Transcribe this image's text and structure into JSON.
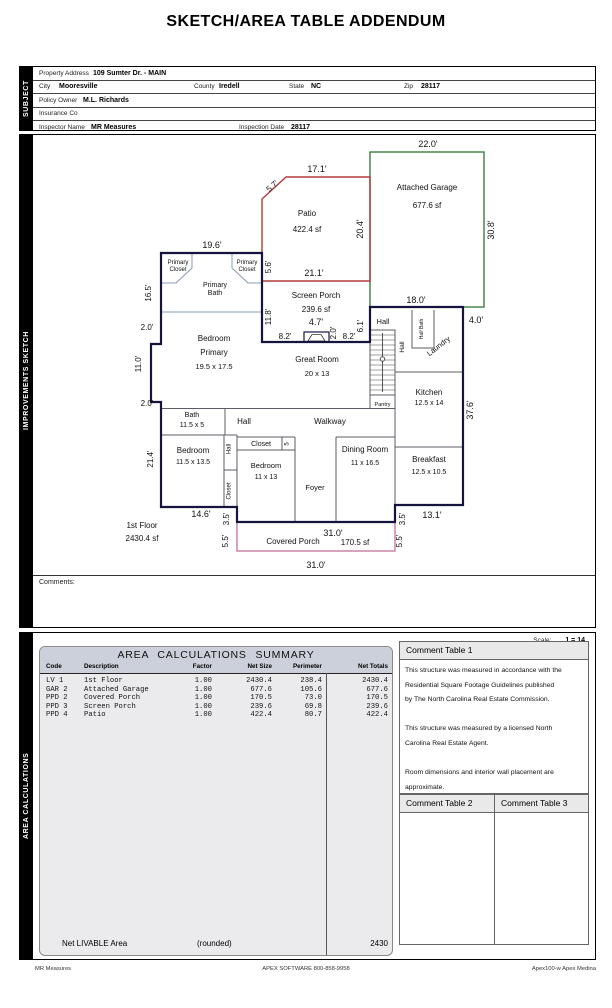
{
  "title": "SKETCH/AREA TABLE ADDENDUM",
  "sidebar": {
    "subject": "SUBJECT",
    "improvements": "IMPROVEMENTS SKETCH",
    "area_calc": "AREA CALCULATIONS"
  },
  "subject": {
    "rows": [
      [
        {
          "x": 6,
          "t": "Property Address"
        },
        {
          "x": 60,
          "t": "109 Sumter Dr. - MAIN",
          "b": 1
        }
      ],
      [
        {
          "x": 6,
          "t": "City"
        },
        {
          "x": 26,
          "t": "Mooresville",
          "b": 1
        },
        {
          "x": 161,
          "t": "County"
        },
        {
          "x": 186,
          "t": "Iredell",
          "b": 1
        },
        {
          "x": 256,
          "t": "State"
        },
        {
          "x": 278,
          "t": "NC",
          "b": 1
        },
        {
          "x": 371,
          "t": "Zip"
        },
        {
          "x": 388,
          "t": "28117",
          "b": 1
        }
      ],
      [
        {
          "x": 6,
          "t": "Policy Owner"
        },
        {
          "x": 50,
          "t": "M.L. Richards",
          "b": 1
        }
      ],
      [
        {
          "x": 6,
          "t": "Insurance Co"
        }
      ],
      [
        {
          "x": 6,
          "t": "Inspector Name"
        },
        {
          "x": 58,
          "t": "MR Measures",
          "b": 1
        },
        {
          "x": 206,
          "t": "Inspection Date"
        },
        {
          "x": 258,
          "t": "28117",
          "b": 1
        }
      ]
    ]
  },
  "sketch": {
    "comments_label": "Comments:",
    "labels": [
      {
        "t": "22.0'",
        "x": 395,
        "y": 12,
        "s": 9
      },
      {
        "t": "Attached Garage",
        "x": 394,
        "y": 55,
        "s": 8
      },
      {
        "t": "677.6 sf",
        "x": 394,
        "y": 73,
        "s": 8
      },
      {
        "t": "30.8'",
        "x": 461,
        "y": 95,
        "s": 9,
        "r": -90
      },
      {
        "t": "18.0'",
        "x": 383,
        "y": 168,
        "s": 9
      },
      {
        "t": "4.0'",
        "x": 443,
        "y": 188,
        "s": 9
      },
      {
        "t": "5.7'",
        "x": 241,
        "y": 53,
        "s": 8,
        "r": -42
      },
      {
        "t": "17.1'",
        "x": 284,
        "y": 37,
        "s": 9
      },
      {
        "t": "Patio",
        "x": 274,
        "y": 81,
        "s": 8
      },
      {
        "t": "422.4 sf",
        "x": 274,
        "y": 97,
        "s": 8
      },
      {
        "t": "20.4'",
        "x": 330,
        "y": 94,
        "s": 9,
        "r": -90
      },
      {
        "t": "5.6'",
        "x": 238,
        "y": 132,
        "s": 8,
        "r": -90
      },
      {
        "t": "21.1'",
        "x": 281,
        "y": 141,
        "s": 9
      },
      {
        "t": "19.6'",
        "x": 179,
        "y": 113,
        "s": 9
      },
      {
        "t": "Primary",
        "x": 145,
        "y": 129,
        "s": 6
      },
      {
        "t": "Closet",
        "x": 145,
        "y": 136,
        "s": 6
      },
      {
        "t": "Primary",
        "x": 214,
        "y": 129,
        "s": 6
      },
      {
        "t": "Closet",
        "x": 214,
        "y": 136,
        "s": 6
      },
      {
        "t": "Primary",
        "x": 182,
        "y": 152,
        "s": 7
      },
      {
        "t": "Bath",
        "x": 182,
        "y": 160,
        "s": 7
      },
      {
        "t": "16.5'",
        "x": 118,
        "y": 158,
        "s": 8,
        "r": -90
      },
      {
        "t": "Screen Porch",
        "x": 283,
        "y": 163,
        "s": 8
      },
      {
        "t": "239.6 sf",
        "x": 283,
        "y": 177,
        "s": 8
      },
      {
        "t": "11.8'",
        "x": 238,
        "y": 182,
        "s": 8,
        "r": -90
      },
      {
        "t": "4.7'",
        "x": 283,
        "y": 190,
        "s": 9
      },
      {
        "t": "8.2'",
        "x": 252,
        "y": 204,
        "s": 8
      },
      {
        "t": "2.0'",
        "x": 303,
        "y": 198,
        "s": 8,
        "r": -90
      },
      {
        "t": "8.2'",
        "x": 316,
        "y": 204,
        "s": 8
      },
      {
        "t": "6.1'",
        "x": 330,
        "y": 191,
        "s": 8,
        "r": -90
      },
      {
        "t": "2.0'",
        "x": 114,
        "y": 195,
        "s": 8
      },
      {
        "t": "Bedroom",
        "x": 181,
        "y": 206,
        "s": 8
      },
      {
        "t": "Primary",
        "x": 181,
        "y": 220,
        "s": 8
      },
      {
        "t": "19.5 x 17.5",
        "x": 181,
        "y": 234,
        "s": 7.5
      },
      {
        "t": "11.0'",
        "x": 108,
        "y": 229,
        "s": 8,
        "r": -90
      },
      {
        "t": "2.0'",
        "x": 114,
        "y": 271,
        "s": 8
      },
      {
        "t": "Great Room",
        "x": 284,
        "y": 227,
        "s": 8
      },
      {
        "t": "20 x 13",
        "x": 284,
        "y": 241,
        "s": 7.5
      },
      {
        "t": "Hall",
        "x": 350,
        "y": 189,
        "s": 7.5
      },
      {
        "t": "Half Bath",
        "x": 390,
        "y": 194,
        "s": 5,
        "r": -90
      },
      {
        "t": "Hall",
        "x": 371,
        "y": 212,
        "s": 6.5,
        "r": -90
      },
      {
        "t": "Laundry",
        "x": 407,
        "y": 213,
        "s": 7.5,
        "r": -38
      },
      {
        "t": "Kitchen",
        "x": 396,
        "y": 260,
        "s": 8
      },
      {
        "t": "12.5 x 14",
        "x": 396,
        "y": 270,
        "s": 7
      },
      {
        "t": "37.6'",
        "x": 440,
        "y": 275,
        "s": 9,
        "r": -90
      },
      {
        "t": "Pantry",
        "x": 349.5,
        "y": 271,
        "s": 5.5
      },
      {
        "t": "Bath",
        "x": 159,
        "y": 282,
        "s": 7
      },
      {
        "t": "11.5 x 5",
        "x": 159,
        "y": 292,
        "s": 7
      },
      {
        "t": "Hall",
        "x": 211,
        "y": 289,
        "s": 8
      },
      {
        "t": "Walkway",
        "x": 297,
        "y": 289,
        "s": 8
      },
      {
        "t": "21.4'",
        "x": 120,
        "y": 324,
        "s": 8,
        "r": -90
      },
      {
        "t": "Bedroom",
        "x": 160,
        "y": 318,
        "s": 8
      },
      {
        "t": "11.5 x 13.5",
        "x": 160,
        "y": 329,
        "s": 7
      },
      {
        "t": "Hall",
        "x": 197.5,
        "y": 314,
        "s": 6,
        "r": -90
      },
      {
        "t": "Closet",
        "x": 228,
        "y": 311,
        "s": 7
      },
      {
        "t": "5",
        "x": 255.5,
        "y": 309,
        "s": 6,
        "r": -90
      },
      {
        "t": "Bedroom",
        "x": 233,
        "y": 333,
        "s": 7.5
      },
      {
        "t": "11 x 13",
        "x": 233,
        "y": 344,
        "s": 7
      },
      {
        "t": "Closet",
        "x": 197.5,
        "y": 356,
        "s": 6,
        "r": -90
      },
      {
        "t": "Foyer",
        "x": 282,
        "y": 355,
        "s": 7.5
      },
      {
        "t": "Dining Room",
        "x": 332,
        "y": 317,
        "s": 8
      },
      {
        "t": "11 x 16.5",
        "x": 332,
        "y": 330,
        "s": 7
      },
      {
        "t": "Breakfast",
        "x": 396,
        "y": 327,
        "s": 8
      },
      {
        "t": "12.5 x 10.5",
        "x": 396,
        "y": 339,
        "s": 7
      },
      {
        "t": "14.6'",
        "x": 168,
        "y": 382,
        "s": 9
      },
      {
        "t": "3.5'",
        "x": 196,
        "y": 384,
        "s": 8,
        "r": -90
      },
      {
        "t": "5.5'",
        "x": 195,
        "y": 406,
        "s": 8,
        "r": -90
      },
      {
        "t": "1st Floor",
        "x": 109,
        "y": 393,
        "s": 8
      },
      {
        "t": "2430.4 sf",
        "x": 109,
        "y": 406,
        "s": 8
      },
      {
        "t": "Covered Porch",
        "x": 260,
        "y": 409,
        "s": 8
      },
      {
        "t": "31.0'",
        "x": 300,
        "y": 401,
        "s": 9
      },
      {
        "t": "170.5 sf",
        "x": 322,
        "y": 410,
        "s": 8
      },
      {
        "t": "3.5'",
        "x": 372,
        "y": 384,
        "s": 8,
        "r": -90
      },
      {
        "t": "13.1'",
        "x": 399,
        "y": 383,
        "s": 9
      },
      {
        "t": "5.5'",
        "x": 369,
        "y": 406,
        "s": 8,
        "r": -90
      },
      {
        "t": "31.0'",
        "x": 283,
        "y": 433,
        "s": 9
      }
    ]
  },
  "area": {
    "scale_label": "Scale:",
    "scale_value": "1 = 14",
    "summary": {
      "title": "AREA  CALCULATIONS  SUMMARY",
      "columns": [
        {
          "label": "Code",
          "key": "code",
          "x": 6,
          "align": "l"
        },
        {
          "label": "Description",
          "key": "desc",
          "x": 44,
          "align": "l"
        },
        {
          "label": "Factor",
          "key": "factor",
          "x": 172,
          "align": "r"
        },
        {
          "label": "Net Size",
          "key": "net_size",
          "x": 232,
          "align": "r"
        },
        {
          "label": "Perimeter",
          "key": "perimeter",
          "x": 282,
          "align": "r"
        },
        {
          "label": "Net Totals",
          "key": "net_totals",
          "x": 348,
          "align": "r"
        }
      ],
      "rows": [
        {
          "code": "LV 1",
          "desc": "1st Floor",
          "factor": "1.00",
          "net_size": "2430.4",
          "perimeter": "238.4",
          "net_totals": "2430.4"
        },
        {
          "code": "GAR 2",
          "desc": "Attached Garage",
          "factor": "1.00",
          "net_size": "677.6",
          "perimeter": "105.6",
          "net_totals": "677.6"
        },
        {
          "code": "PPD 2",
          "desc": "Covered Porch",
          "factor": "1.00",
          "net_size": "170.5",
          "perimeter": "73.0",
          "net_totals": "170.5"
        },
        {
          "code": "PPD 3",
          "desc": "Screen Porch",
          "factor": "1.00",
          "net_size": "239.6",
          "perimeter": "69.8",
          "net_totals": "239.6"
        },
        {
          "code": "PPD 4",
          "desc": "Patio",
          "factor": "1.00",
          "net_size": "422.4",
          "perimeter": "80.7",
          "net_totals": "422.4"
        }
      ],
      "net_livable_label": "Net LIVABLE Area",
      "rounded_label": "(rounded)",
      "net_livable_value": "2430"
    },
    "comment_tables": {
      "t1_title": "Comment Table 1",
      "t1_lines": [
        "This structure was measured in accordance with the",
        "Residential Square Footage Guidelines published",
        "by The North Carolina Real Estate Commission.",
        "",
        "This structure was measured by a licensed North",
        "Carolina Real Estate Agent.",
        "",
        "Room dimensions and interior wall placement are",
        "approximate."
      ],
      "t2_title": "Comment Table 2",
      "t3_title": "Comment Table 3"
    }
  },
  "footer": {
    "left": "MR Measures",
    "center": "APEX SOFTWARE 800-858-9958",
    "right": "Apex100-w Apex Medina"
  },
  "colors": {
    "wall": "#14143f",
    "patio_outline": "#b23b3b",
    "garage_outline": "#3e7c3e",
    "porch_outline": "#c97ca4",
    "interior_wall": "#5c5c66",
    "closet_line": "#8b99b5",
    "table_header_bg": "#ccd0da",
    "table_body_bg": "#ebebee",
    "tab_bg": "#000000"
  }
}
